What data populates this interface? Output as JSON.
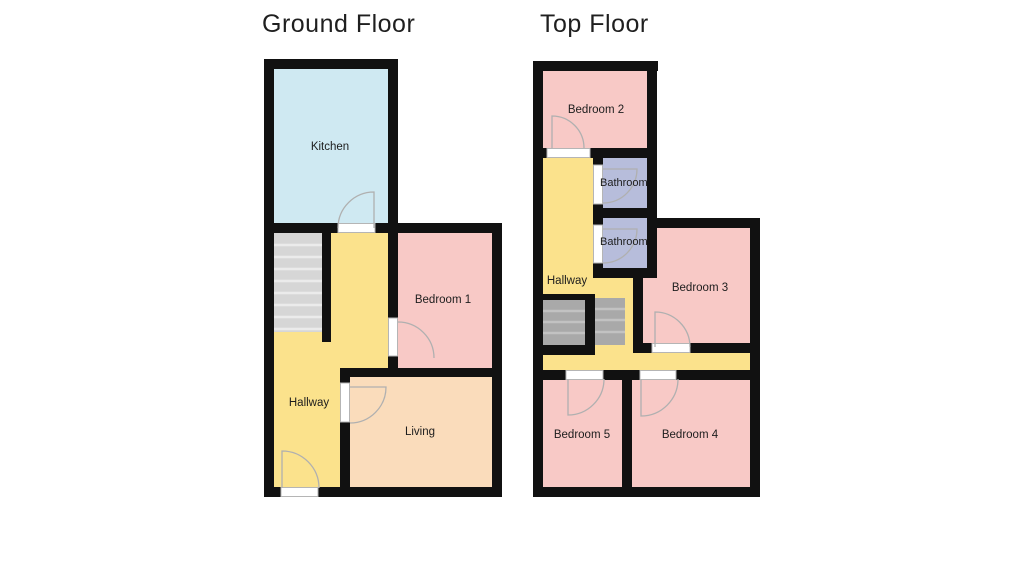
{
  "floors": [
    {
      "title": "Ground Floor",
      "rooms": {
        "kitchen": {
          "label": "Kitchen"
        },
        "bedroom1": {
          "label": "Bedroom 1"
        },
        "hallway": {
          "label": "Hallway"
        },
        "living": {
          "label": "Living"
        }
      }
    },
    {
      "title": "Top Floor",
      "rooms": {
        "bedroom2": {
          "label": "Bedroom 2"
        },
        "bathroom_upper": {
          "label": "Bathroom"
        },
        "bathroom_lower": {
          "label": "Bathroom"
        },
        "hallway": {
          "label": "Hallway"
        },
        "bedroom3": {
          "label": "Bedroom 3"
        },
        "bedroom5": {
          "label": "Bedroom 5"
        },
        "bedroom4": {
          "label": "Bedroom 4"
        }
      }
    }
  ],
  "colors": {
    "wall": "#111111",
    "kitchen": "#cfe9f2",
    "bedroom": "#f8c9c6",
    "living": "#fadcbb",
    "hallway": "#fbe28c",
    "bathroom": "#b7bddb",
    "stairs_light": "#d6d6d6",
    "stairs_dark": "#a9a9a9",
    "door_jamb": "#ffffff",
    "text": "#1d1d1d"
  }
}
